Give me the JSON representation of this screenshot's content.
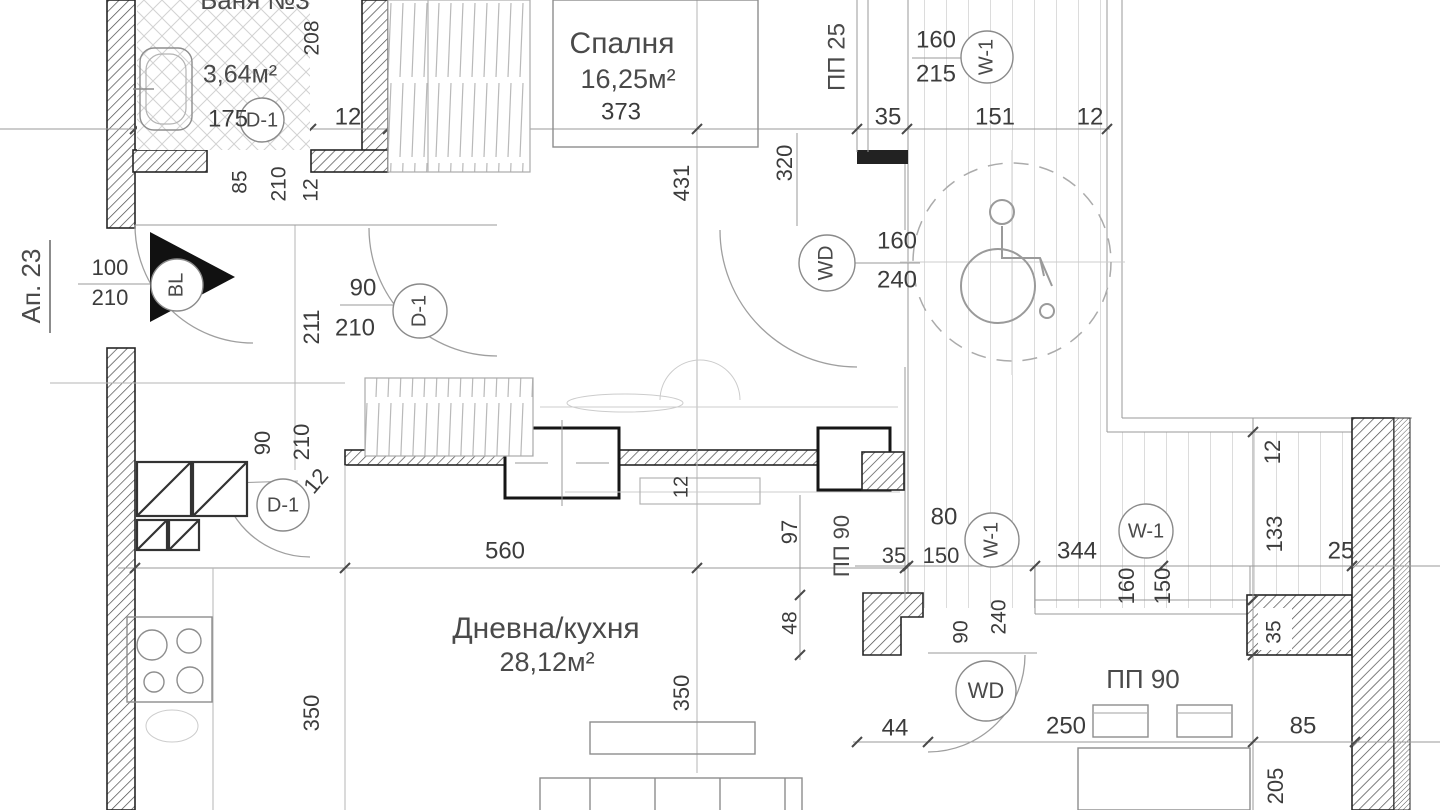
{
  "plan": {
    "apartment": "Ап. 23"
  },
  "rooms": {
    "bathroom": {
      "title_partial": "Баня №3",
      "area": "3,64м²"
    },
    "bedroom": {
      "name": "Спалня",
      "area": "16,25м²"
    },
    "living": {
      "name": "Дневна/кухня",
      "area": "28,12м²"
    }
  },
  "tags": {
    "bl": "BL",
    "d1": "D-1",
    "w1": "W-1",
    "wd": "WD",
    "pp25": "ПП 25",
    "pp90": "ПП 90"
  },
  "dims": {
    "n12": "12",
    "n25": "25",
    "n35": "35",
    "n44": "44",
    "n48": "48",
    "n80": "80",
    "n85": "85",
    "n90": "90",
    "n97": "97",
    "n100": "100",
    "n133": "133",
    "n150": "150",
    "n151": "151",
    "n160": "160",
    "n175": "175",
    "n205": "205",
    "n208": "208",
    "n210": "210",
    "n211": "211",
    "n215": "215",
    "n240": "240",
    "n250": "250",
    "n320": "320",
    "n344": "344",
    "n350": "350",
    "n373": "373",
    "n431": "431",
    "n560": "560"
  },
  "colors": {
    "wall_line": "#262626",
    "dim_text": "#3c3c3c",
    "deck_line": "#c4c4c4",
    "line": "#9a9a9a"
  }
}
